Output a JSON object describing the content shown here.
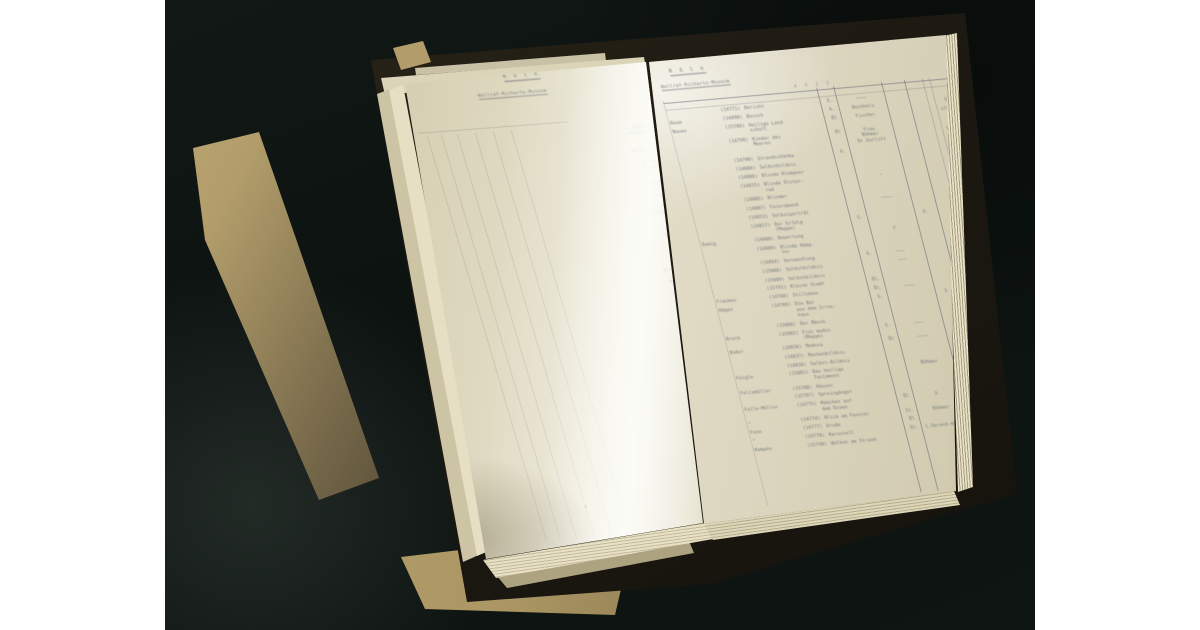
{
  "photo": {
    "description": "Photograph of an open typewritten inventory ledger on a dark surface, tan folders beneath",
    "background_color": "#0c1210",
    "margin_color": "#ffffff",
    "page_color": "#e8e3d0",
    "folder_color": "#b8a36e"
  },
  "left_page": {
    "header_title": "K ö l n",
    "header_subtitle": "Wallraf-Richartz-Museum",
    "page_number": "- 4 -",
    "lines": [
      {
        "text": "Abstraktion auf"
      },
      {
        "text": "vergoldetem Grund"
      },
      {
        "text": ""
      },
      {
        "text": "Bildnis und"
      },
      {
        "text": "Selbstbildnis 1921"
      },
      {
        "text": ""
      },
      {
        "text": "Öl auf Leinwand"
      },
      {
        "text": "Komposition 1926"
      },
      {
        "text": ""
      },
      {
        "text": ""
      },
      {
        "text": "Mädchen am Tisch"
      },
      {
        "text": ""
      },
      {
        "text": "Frauenkopf 1920"
      },
      {
        "text": ""
      },
      {
        "text": "Stilleben mit"
      },
      {
        "text": "Früchten und Krug"
      },
      {
        "text": ""
      },
      {
        "text": ""
      },
      {
        "text": "Landschaft mit"
      },
      {
        "text": "Häusern am Hang"
      },
      {
        "text": ""
      },
      {
        "text": "Blick auf die"
      },
      {
        "text": "Stadt am Abend"
      },
      {
        "text": ""
      },
      {
        "text": ""
      },
      {
        "text": "Bildnis der Frau M."
      },
      {
        "text": ""
      },
      {
        "text": "Mappe mit 12 Blatt"
      },
      {
        "text": ""
      },
      {
        "text": "VII   4   1926   40"
      }
    ]
  },
  "right_page": {
    "page_number_top": "- 5 -",
    "page_number_bottom": "- 5 -",
    "header_title": "K ö l n",
    "header_subtitle": "Wallraf-Richartz-Museum",
    "column_marks": "4 2 2 2",
    "rows": [
      {
        "name": "",
        "no": "(14771)",
        "title": "Bericht",
        "med": "E.",
        "dealer": "————",
        "extra": "",
        "price": ""
      },
      {
        "name": "Baum",
        "no": "(14898)",
        "title": "Besuch",
        "med": "A.",
        "dealer": "Buchholz",
        "extra": "",
        "price": "$ 100.-"
      },
      {
        "name": "Nauen",
        "no": "(15786)",
        "title": "Heilige Land-\nschaft",
        "med": "Öl",
        "dealer": "Fischer",
        "extra": "",
        "price": "sfr 400.-"
      },
      {
        "name": "",
        "no": "(14799)",
        "title": "Kinder des\nMeeres",
        "med": "Öl",
        "dealer": "Frau\nBöhmer\nDr.Gurlitt",
        "extra": "",
        "price": "£ 10.-\nsfr 150.-"
      },
      {
        "name": "",
        "no": "(14790)",
        "title": "Strandschänke",
        "med": "A.",
        "dealer": "",
        "extra": "",
        "price": "hfl 160.-"
      },
      {
        "name": "",
        "no": "(14804)",
        "title": "Selbstbildnis",
        "med": "",
        "dealer": "",
        "extra": "",
        "price": ""
      },
      {
        "name": "",
        "no": "(14806)",
        "title": "Blinde Klempner",
        "med": "",
        "dealer": "",
        "extra": "",
        "price": "sfrs 800.-"
      },
      {
        "name": "",
        "no": "(14815)",
        "title": "Blinde Elster-\nrad",
        "med": "",
        "dealer": "—",
        "extra": "",
        "price": ""
      },
      {
        "name": "",
        "no": "(14805)",
        "title": "Blinder",
        "med": "",
        "dealer": "",
        "extra": "",
        "price": ""
      },
      {
        "name": "",
        "no": "(14807)",
        "title": "Feierabend",
        "med": "",
        "dealer": "————",
        "extra": "",
        "price": ""
      },
      {
        "name": "",
        "no": "(14813)",
        "title": "Selbstporträt",
        "med": "",
        "dealer": "",
        "extra": "",
        "price": ""
      },
      {
        "name": "",
        "no": "(14817)",
        "title": "Der Erfolg\n(Mappe)",
        "med": "G.",
        "dealer": "",
        "extra": "3.",
        "price": ""
      },
      {
        "name": "Zweig",
        "no": "(14808)",
        "title": "Bewertung",
        "med": "",
        "dealer": "F",
        "extra": "",
        "price": ""
      },
      {
        "name": "",
        "no": "(14809)",
        "title": "Blinde Kämp-\nfer",
        "med": "",
        "dealer": "",
        "extra": "",
        "price": ""
      },
      {
        "name": "",
        "no": "(14864)",
        "title": "Verwandlung",
        "med": "G.",
        "dealer": "———",
        "extra": "",
        "price": ""
      },
      {
        "name": "",
        "no": "(15008)",
        "title": "Selbstbildnis",
        "med": "",
        "dealer": "———",
        "extra": "",
        "price": ""
      },
      {
        "name": "",
        "no": "(15009)",
        "title": "Selbstbildnis",
        "med": "",
        "dealer": "",
        "extra": "",
        "price": ""
      },
      {
        "name": "",
        "no": "(15791)",
        "title": "Kleine Stadt",
        "med": "Öl.",
        "dealer": "",
        "extra": "",
        "price": ""
      },
      {
        "name": "Franken",
        "no": "(14768)",
        "title": "Stilleben",
        "med": "Öl.",
        "dealer": "————",
        "extra": "",
        "price": ""
      },
      {
        "name": "Högen",
        "no": "(14769)",
        "title": "Die Bar\naus dem Irren-\nhaus",
        "med": "G.",
        "dealer": "",
        "extra": "3",
        "price": ""
      },
      {
        "name": "",
        "no": "(15080)",
        "title": "Der Mönch",
        "med": "",
        "dealer": "",
        "extra": "",
        "price": ""
      },
      {
        "name": "Brock",
        "no": "(15082)",
        "title": "Fiat modes\n(Mappe)",
        "med": "G.",
        "dealer": "———",
        "extra": "",
        "price": ""
      },
      {
        "name": "Bodur",
        "no": "(14836)",
        "title": "Medusa",
        "med": "Öl",
        "dealer": "————",
        "extra": "",
        "price": ""
      },
      {
        "name": "",
        "no": "(14837)",
        "title": "Maskenbildnis",
        "med": "",
        "dealer": "",
        "extra": "",
        "price": ""
      },
      {
        "name": "",
        "no": "(14838)",
        "title": "Selbst-Bildnis",
        "med": "",
        "dealer": "",
        "extra": "",
        "price": ""
      },
      {
        "name": "Feigle",
        "no": "(15001)",
        "title": "Das heilige\nTestament",
        "med": "",
        "dealer": "Böhmer",
        "extra": "3.",
        "price": ""
      },
      {
        "name": "Felixmüller",
        "no": "(15780)",
        "title": "Häuser",
        "med": "",
        "dealer": "",
        "extra": "3.",
        "price": ""
      },
      {
        "name": "",
        "no": "(15797)",
        "title": "Spreizgänger",
        "med": "",
        "dealer": "",
        "extra": "3.",
        "price": ""
      },
      {
        "name": "Felle-Müller",
        "no": "(14775)",
        "title": "Mädchen auf\ndem Diwan",
        "med": "Öl",
        "dealer": "3.",
        "extra": "3.",
        "price": ""
      },
      {
        "name": "\"",
        "no": "(14774)",
        "title": "Blick am Fenster",
        "med": "Sl.",
        "dealer": "Böhmer",
        "extra": "3",
        "price": "1 ?"
      },
      {
        "name": "Fene",
        "no": "(14777)",
        "title": "Drude",
        "med": "Öl",
        "dealer": "",
        "extra": "",
        "price": ""
      },
      {
        "name": "\"",
        "no": "(14778)",
        "title": "Karussell",
        "med": "St.",
        "dealer": "L.Geroch-König",
        "extra": "",
        "price": ""
      },
      {
        "name": "Kempén",
        "no": "(15748)",
        "title": "Wolken am Strand",
        "med": "",
        "dealer": "",
        "extra": "",
        "price": ""
      }
    ]
  }
}
